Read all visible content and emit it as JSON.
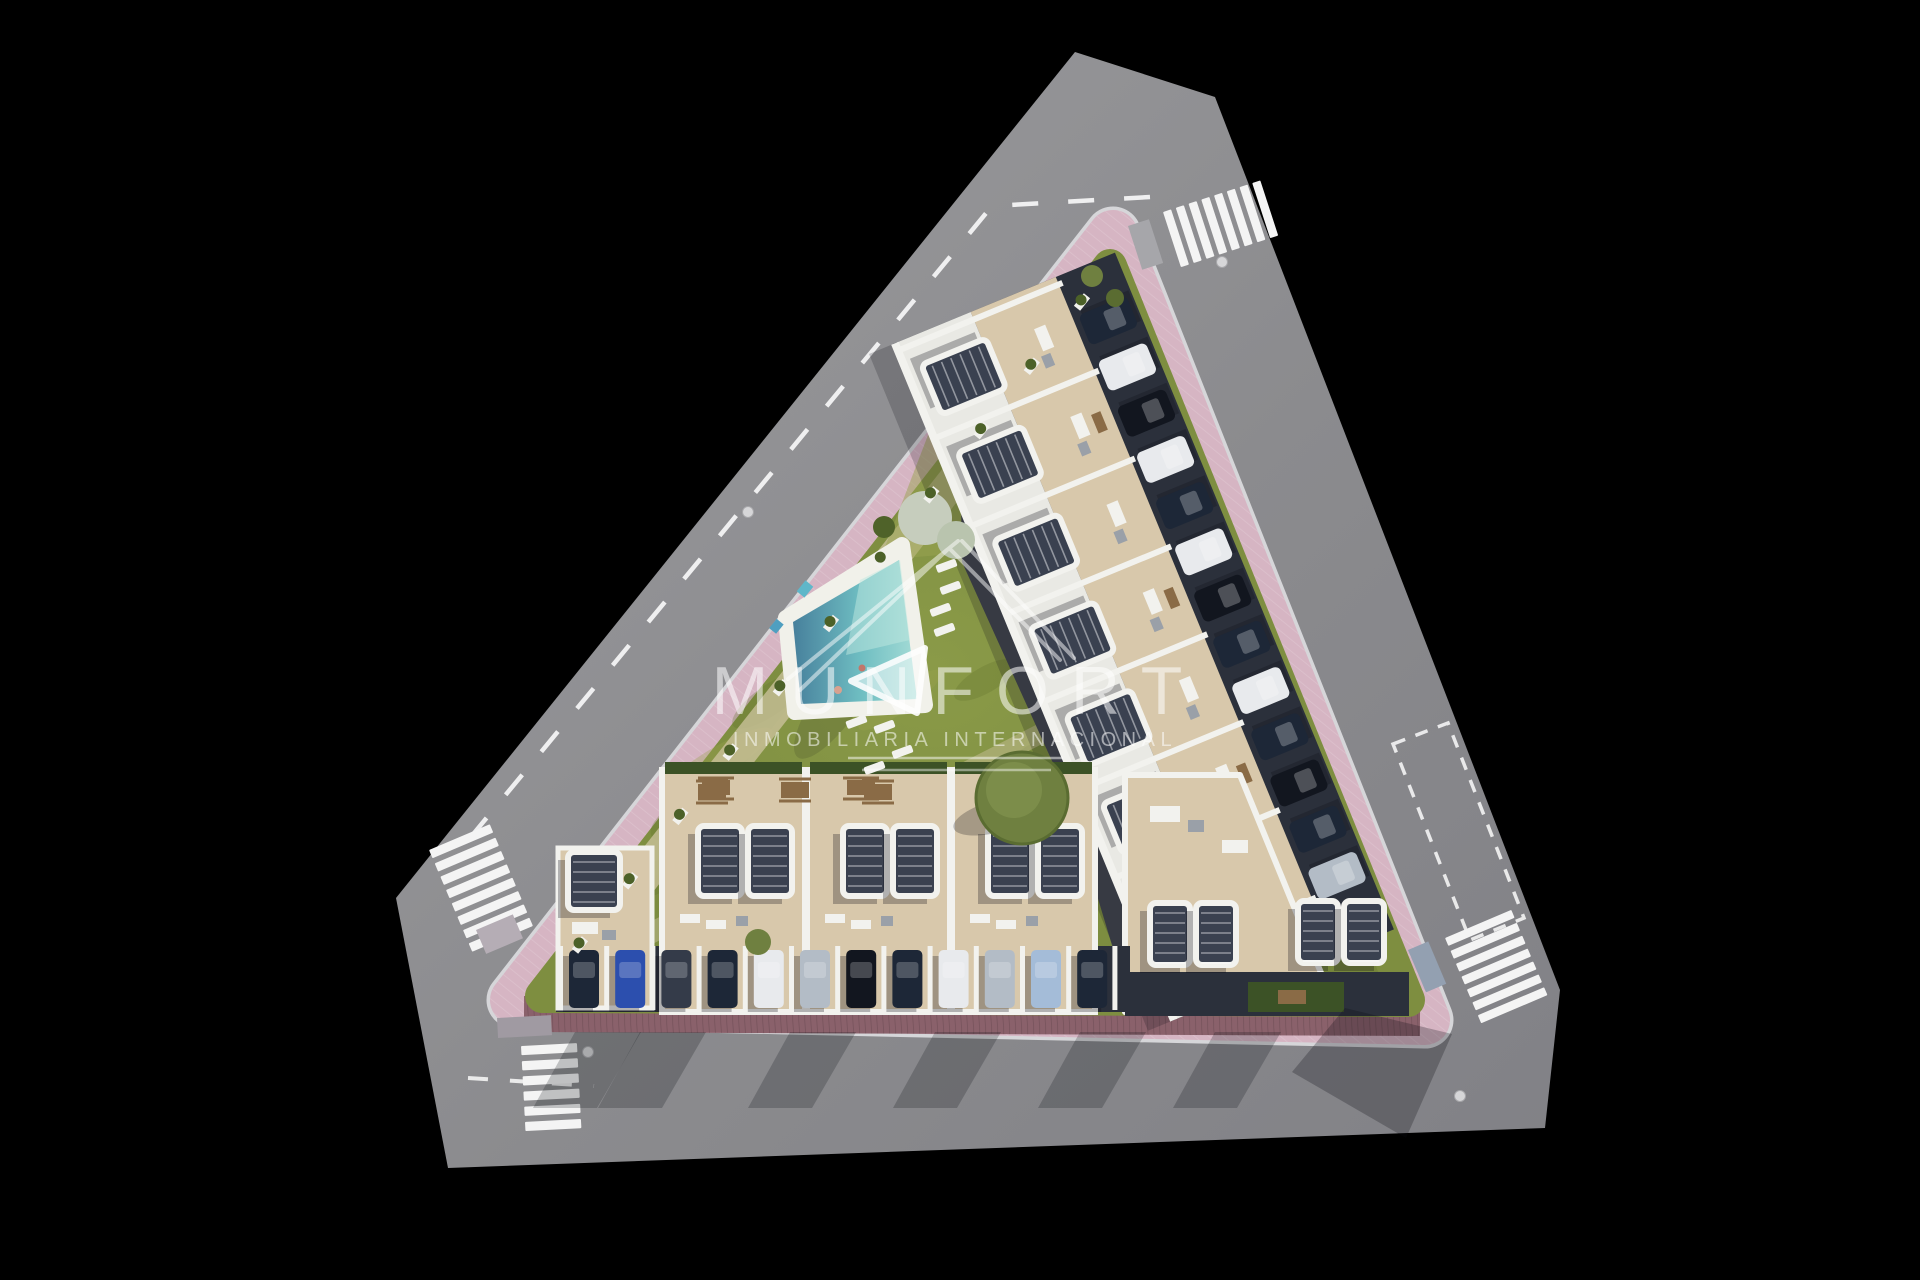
{
  "watermark": {
    "brand": "MUNFORT",
    "tagline": "INMOBILIARIA INTERNACIONAL"
  },
  "palette": {
    "bg": "#000000",
    "road": "#8e8e91",
    "road_light": "#9c9c9f",
    "road_dark": "#7f7f84",
    "marking": "#f4f4f4",
    "sidewalk_pink": "#d6b5c3",
    "sidewalk_pink_light": "#e2c6d2",
    "sidewalk_brick": "#8a616b",
    "curb": "#d6d6d9",
    "garden": "#7e8e40",
    "garden_dark": "#64752f",
    "garden_light": "#9aa351",
    "path_beige": "#cfc4a0",
    "deck": "#f1f1ea",
    "water_deep": "#47809c",
    "water_mid": "#6fbec2",
    "water_light": "#a5dcd6",
    "roof_white": "#f2f2ee",
    "terrace": "#d8c8ab",
    "terrace_dark": "#c4b392",
    "pergola": "#3a4150",
    "facade": "#2b303b",
    "drive": "#43474f",
    "hedge": "#3c5226",
    "tree_olive": "#6f8040",
    "tree_pale": "#c6cdbd",
    "wood": "#8a6b46",
    "car_navy": "#1d2737",
    "car_black": "#12161f",
    "car_white": "#e8eaed",
    "car_silver": "#b3bcc6",
    "car_blue": "#2c4fae",
    "car_lightblue": "#a4bcd8",
    "car_charcoal": "#343b49",
    "watermark": "#ffffff"
  },
  "site": {
    "bottom_row_cars": [
      "navy",
      "blue",
      "charcoal",
      "navy",
      "white",
      "silver",
      "black",
      "navy",
      "white",
      "silver",
      "lightblue",
      "navy"
    ],
    "ne_row_cars": [
      "navy",
      "white",
      "black",
      "white",
      "navy",
      "white",
      "black",
      "navy",
      "white",
      "navy",
      "black",
      "navy",
      "silver"
    ],
    "driveway_cars": [
      "navy",
      "white",
      "black"
    ],
    "crosswalks": {
      "top_stripes": 8,
      "left_stripes": 8,
      "bottom_stripes": 6,
      "right_stripes": 7
    },
    "manholes": 4
  }
}
